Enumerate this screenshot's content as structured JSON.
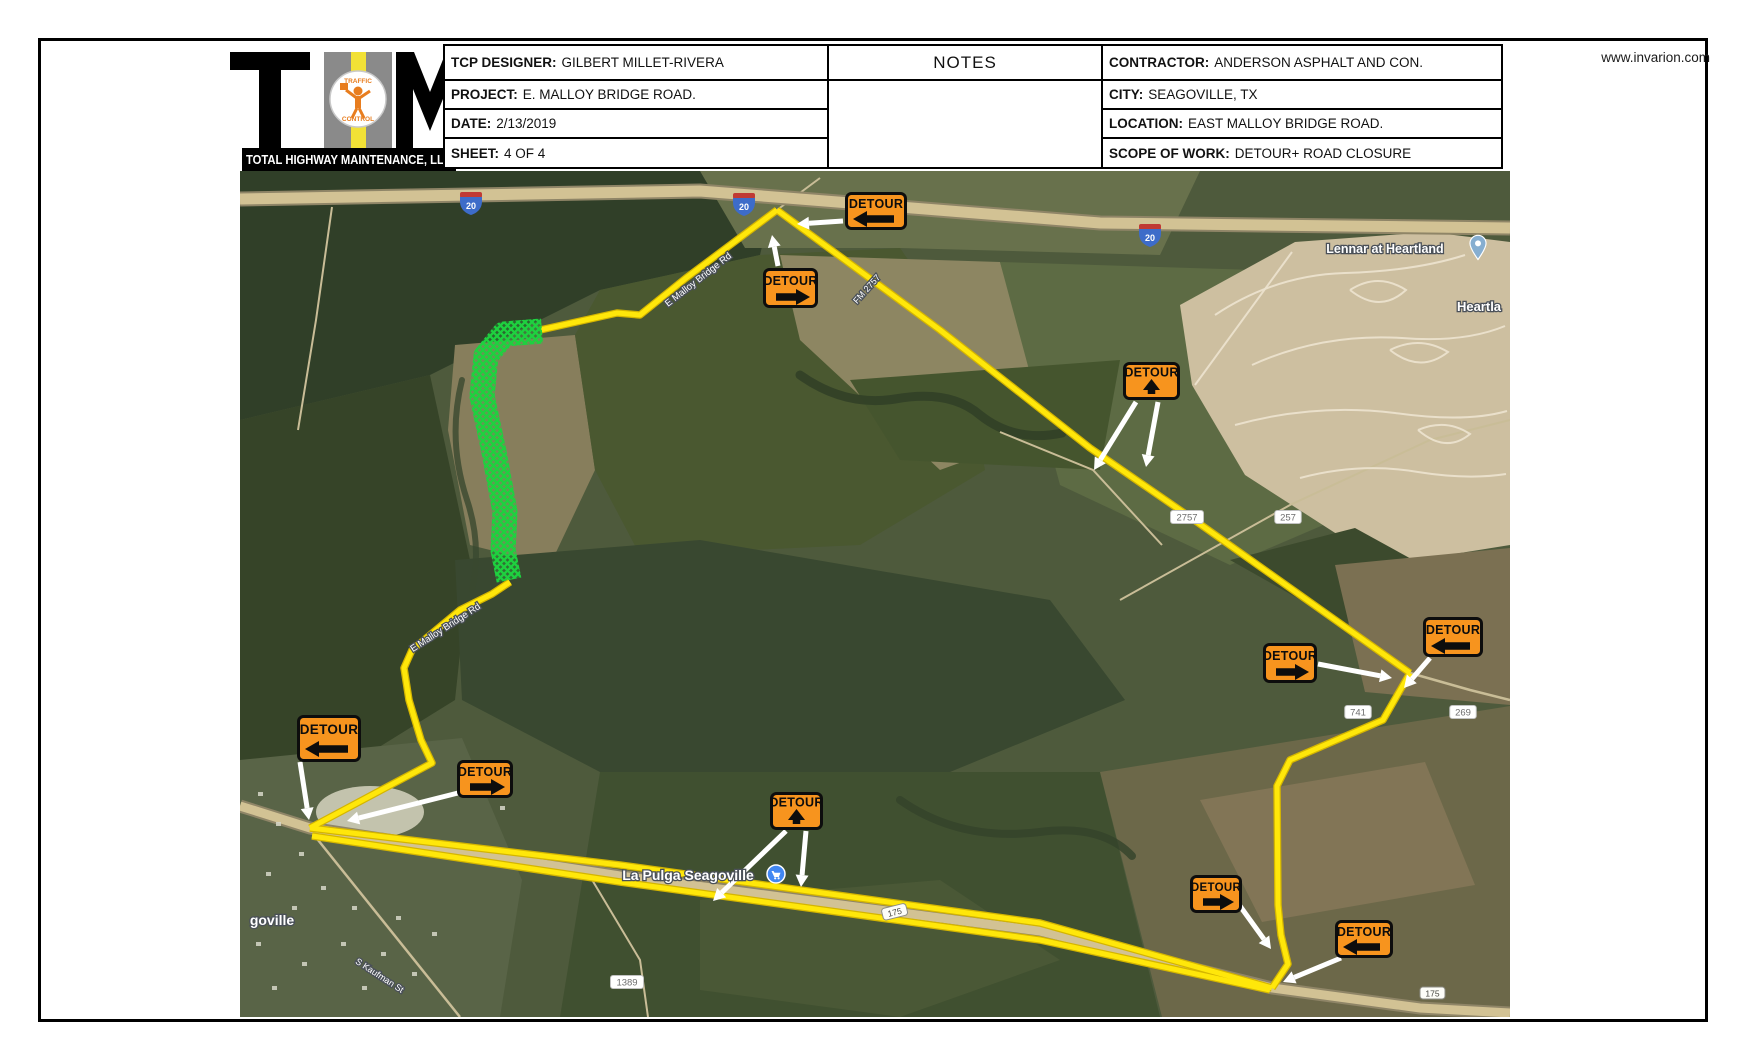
{
  "header": {
    "website": "www.invarion.com",
    "logo": {
      "banner": "TOTAL HIGHWAY MAINTENANCE, LLC",
      "emblem_top": "TRAFFIC",
      "emblem_bottom": "CONTROL"
    },
    "left_table": {
      "rows": [
        {
          "label": "TCP DESIGNER:",
          "value": "GILBERT MILLET-RIVERA"
        },
        {
          "label": "PROJECT:",
          "value": "E. MALLOY BRIDGE ROAD."
        },
        {
          "label": "DATE:",
          "value": "2/13/2019"
        },
        {
          "label": "SHEET:",
          "value": "4 OF 4"
        }
      ]
    },
    "notes_title": "NOTES",
    "right_table": {
      "rows": [
        {
          "label": "CONTRACTOR:",
          "value": "ANDERSON ASPHALT AND CON."
        },
        {
          "label": "CITY:",
          "value": "SEAGOVILLE, TX"
        },
        {
          "label": "LOCATION:",
          "value": "EAST MALLOY BRIDGE ROAD."
        },
        {
          "label": "SCOPE OF WORK:",
          "value": "DETOUR+ ROAD CLOSURE"
        }
      ]
    }
  },
  "map": {
    "colors": {
      "base": "#4e5a3c",
      "road": "#d2c294",
      "road_casing": "#8f8567",
      "thin_road": "#c9bd97",
      "street": "#ebe2cd",
      "route_yellow": "#ffe70a",
      "route_casing": "#d4b500",
      "closure_green": "#1ed13f",
      "arrow_white": "#ffffff",
      "sign_orange": "#F7941E",
      "sign_border": "#0d0d0d"
    },
    "patches": [
      {
        "pts": "240,171 780,171 760,255 600,290 430,375 240,420",
        "fill": "#303f28"
      },
      {
        "pts": "700,171 1200,171 1160,255 900,248 745,248",
        "fill": "#68714c"
      },
      {
        "pts": "240,420 430,375 470,560 455,700 310,790 240,775",
        "fill": "#364428"
      },
      {
        "pts": "455,345 575,335 595,470 550,565 470,545 448,430",
        "fill": "#877e5c"
      },
      {
        "pts": "600,290 760,255 900,248 960,335 985,470 860,545 640,555 595,470 575,335",
        "fill": "#4a5830"
      },
      {
        "pts": "780,255 1000,262 1050,430 940,470 800,340",
        "fill": "#8d8662"
      },
      {
        "pts": "1000,262 1320,272 1335,520 1230,565 1060,485",
        "fill": "#5d6b44"
      },
      {
        "pts": "850,380 1120,360 1100,470 900,460",
        "fill": "#45552e"
      },
      {
        "pts": "1180,305 1295,242 1430,232 1510,242 1510,545 1385,565 1245,475 1192,385",
        "fill": "#cdbfa0"
      },
      {
        "pts": "1230,560 1355,528 1435,572 1345,625",
        "fill": "#3c4a2d"
      },
      {
        "pts": "1335,565 1510,548 1510,705 1365,692",
        "fill": "#7b7052"
      },
      {
        "pts": "455,560 700,540 1050,600 1125,700 950,772 600,772 462,700",
        "fill": "#394830"
      },
      {
        "pts": "600,772 1100,772 1160,1017 560,1017",
        "fill": "#405030"
      },
      {
        "pts": "1100,772 1510,706 1510,1017 1162,1017",
        "fill": "#6c6849"
      },
      {
        "pts": "1200,800 1425,762 1475,885 1262,922",
        "fill": "#827556"
      },
      {
        "pts": "240,760 462,738 522,880 500,1017 240,1017",
        "fill": "#596447"
      },
      {
        "pts": "700,900 940,880 1060,960 900,1017 700,990",
        "fill": "#4a5836"
      },
      {
        "ellipse": [
          370,
          812,
          54,
          26
        ],
        "fill": "#d6d3c0"
      }
    ],
    "creeks": [
      {
        "d": "M800,375 q45,32 95,24 q55,-10 85,16 q35,28 82,18",
        "w": 9,
        "c": "#2e3d25"
      },
      {
        "d": "M900,800 q60,42 140,32 q62,-8 92,24",
        "w": 8,
        "c": "#33422a"
      },
      {
        "d": "M462,380 q-15,60 5,120 q15,45 5,90",
        "w": 6,
        "c": "#3a4930"
      }
    ],
    "thin_roads": [
      {
        "d": "M332,207 L316,320 L298,430",
        "w": 2
      },
      {
        "d": "M310,830 L460,1017",
        "w": 2.5
      },
      {
        "d": "M585,868 L640,960 L648,1017",
        "w": 2
      },
      {
        "d": "M1410,673 L1470,690 L1510,700",
        "w": 2.5
      },
      {
        "d": "M1120,600 L1290,505 L1430,440 L1510,420",
        "w": 2
      },
      {
        "d": "M1000,432 L1093,470 L1162,545",
        "w": 2
      },
      {
        "d": "M777,210 L820,178",
        "w": 2
      }
    ],
    "highways": [
      {
        "pts": "240,199 700,191 1100,223 1510,228",
        "w": 11,
        "cw": 15
      },
      {
        "pts": "240,806 310,828 620,876 1040,931 1272,988 1420,1008 1510,1013",
        "w": 9,
        "cw": 13
      }
    ],
    "housing_streets": [
      "M1215,315 q60,-40 130,-42 q70,-2 120,-18",
      "M1252,365 q70,-32 150,-27 q62,5 103,-12",
      "M1235,425 q80,-22 160,-12 q70,10 112,-2",
      "M1300,478 q60,-16 118,-6 q50,8 88,2",
      "M1195,385 L1292,252",
      "M1350,290 q28,-18 56,0 q-26,24 -56,0",
      "M1390,350 q30,-15 58,2 q-28,22 -58,-2",
      "M1418,430 q28,-12 52,4 q-24,20 -52,-4"
    ],
    "town_dots": [
      [
        258,
        792
      ],
      [
        276,
        822
      ],
      [
        299,
        852
      ],
      [
        266,
        872
      ],
      [
        321,
        886
      ],
      [
        352,
        906
      ],
      [
        292,
        906
      ],
      [
        341,
        942
      ],
      [
        381,
        952
      ],
      [
        302,
        962
      ],
      [
        272,
        986
      ],
      [
        362,
        986
      ],
      [
        412,
        972
      ],
      [
        432,
        932
      ],
      [
        396,
        916
      ],
      [
        256,
        942
      ],
      [
        470,
        782
      ],
      [
        500,
        806
      ]
    ],
    "closure_path": "M542,331 L504,334 L486,356 L482,396 L494,452 L505,512 L503,550 L509,580",
    "route_paths": [
      "M777,210 L686,278 L640,315 L617,313 L540,330",
      "M510,582 L492,594 L460,610 L412,650 L404,668 L409,700 L421,740 L432,763 L310,828",
      "M777,210 L940,330 L1090,448 L1190,517 L1410,673",
      "M1410,673 L1383,720 L1290,760 L1277,786 L1278,905 L1281,935 L1288,964 L1272,988",
      "M310,828 L620,865 L1040,923 L1272,988",
      "M312,836 L620,882 L1040,940 L1270,990"
    ],
    "arrows": [
      [
        843,
        221,
        797,
        224
      ],
      [
        778,
        266,
        772,
        235
      ],
      [
        1136,
        402,
        1094,
        470
      ],
      [
        1158,
        402,
        1146,
        467
      ],
      [
        1318,
        664,
        1392,
        678
      ],
      [
        1430,
        658,
        1404,
        688
      ],
      [
        300,
        762,
        309,
        820
      ],
      [
        458,
        793,
        347,
        821
      ],
      [
        786,
        831,
        713,
        901
      ],
      [
        806,
        831,
        801,
        887
      ],
      [
        1240,
        906,
        1271,
        949
      ],
      [
        1341,
        958,
        1283,
        982
      ]
    ],
    "signs": [
      {
        "label": "DETOUR",
        "x": 845,
        "y": 192,
        "w": 62,
        "h": 38,
        "dir": "left"
      },
      {
        "label": "DETOUR",
        "x": 763,
        "y": 268,
        "w": 55,
        "h": 40,
        "dir": "right"
      },
      {
        "label": "DETOUR",
        "x": 1123,
        "y": 362,
        "w": 57,
        "h": 38,
        "dir": "up"
      },
      {
        "label": "DETOUR",
        "x": 1263,
        "y": 643,
        "w": 54,
        "h": 40,
        "dir": "right"
      },
      {
        "label": "DETOUR",
        "x": 1423,
        "y": 617,
        "w": 60,
        "h": 40,
        "dir": "left"
      },
      {
        "label": "DETOUR",
        "x": 297,
        "y": 715,
        "w": 64,
        "h": 47,
        "dir": "left"
      },
      {
        "label": "DETOUR",
        "x": 457,
        "y": 760,
        "w": 56,
        "h": 38,
        "dir": "right"
      },
      {
        "label": "DETOUR",
        "x": 770,
        "y": 792,
        "w": 53,
        "h": 38,
        "dir": "up"
      },
      {
        "label": "DETOUR",
        "x": 1190,
        "y": 875,
        "w": 52,
        "h": 38,
        "dir": "right"
      },
      {
        "label": "DETOUR",
        "x": 1335,
        "y": 920,
        "w": 58,
        "h": 38,
        "dir": "left"
      }
    ],
    "interstate_shields": [
      {
        "x": 460,
        "y": 192,
        "label": "20"
      },
      {
        "x": 733,
        "y": 193,
        "label": "20"
      },
      {
        "x": 1139,
        "y": 224,
        "label": "20"
      }
    ],
    "route_shields": [
      {
        "x": 881,
        "y": 909,
        "rot": -14,
        "label": "175"
      },
      {
        "x": 1420,
        "y": 987,
        "rot": 0,
        "label": "175"
      }
    ],
    "road_labels": [
      {
        "x": 1187,
        "y": 517,
        "text": "2757"
      },
      {
        "x": 1288,
        "y": 517,
        "text": "257"
      },
      {
        "x": 1358,
        "y": 712,
        "text": "741"
      },
      {
        "x": 1463,
        "y": 712,
        "text": "269"
      },
      {
        "x": 627,
        "y": 982,
        "text": "1389"
      }
    ],
    "place_labels": [
      {
        "x": 1385,
        "y": 253,
        "text": "Lennar at Heartland",
        "size": 12.5,
        "rot": 0,
        "bold": true
      },
      {
        "x": 1479,
        "y": 311,
        "text": "Heartla",
        "size": 13,
        "rot": 0,
        "bold": true
      },
      {
        "x": 688,
        "y": 880,
        "text": "La Pulga Seagoville",
        "size": 14,
        "rot": 0,
        "bold": true
      },
      {
        "x": 272,
        "y": 925,
        "text": "goville",
        "size": 14,
        "rot": 0,
        "bold": true
      },
      {
        "x": 700,
        "y": 282,
        "text": "E Malloy Bridge Rd",
        "size": 9.5,
        "rot": -38,
        "bold": false
      },
      {
        "x": 447,
        "y": 630,
        "text": "E Malloy Bridge Rd",
        "size": 9.5,
        "rot": -33,
        "bold": false
      },
      {
        "x": 869,
        "y": 291,
        "text": "FM 2757",
        "size": 9,
        "rot": -48,
        "bold": false
      },
      {
        "x": 378,
        "y": 978,
        "text": "S Kaufman St",
        "size": 9,
        "rot": 33,
        "bold": false
      }
    ],
    "icons": {
      "lennar_pin": {
        "x": 1478,
        "y": 248
      },
      "store": {
        "x": 776,
        "y": 874
      }
    }
  }
}
